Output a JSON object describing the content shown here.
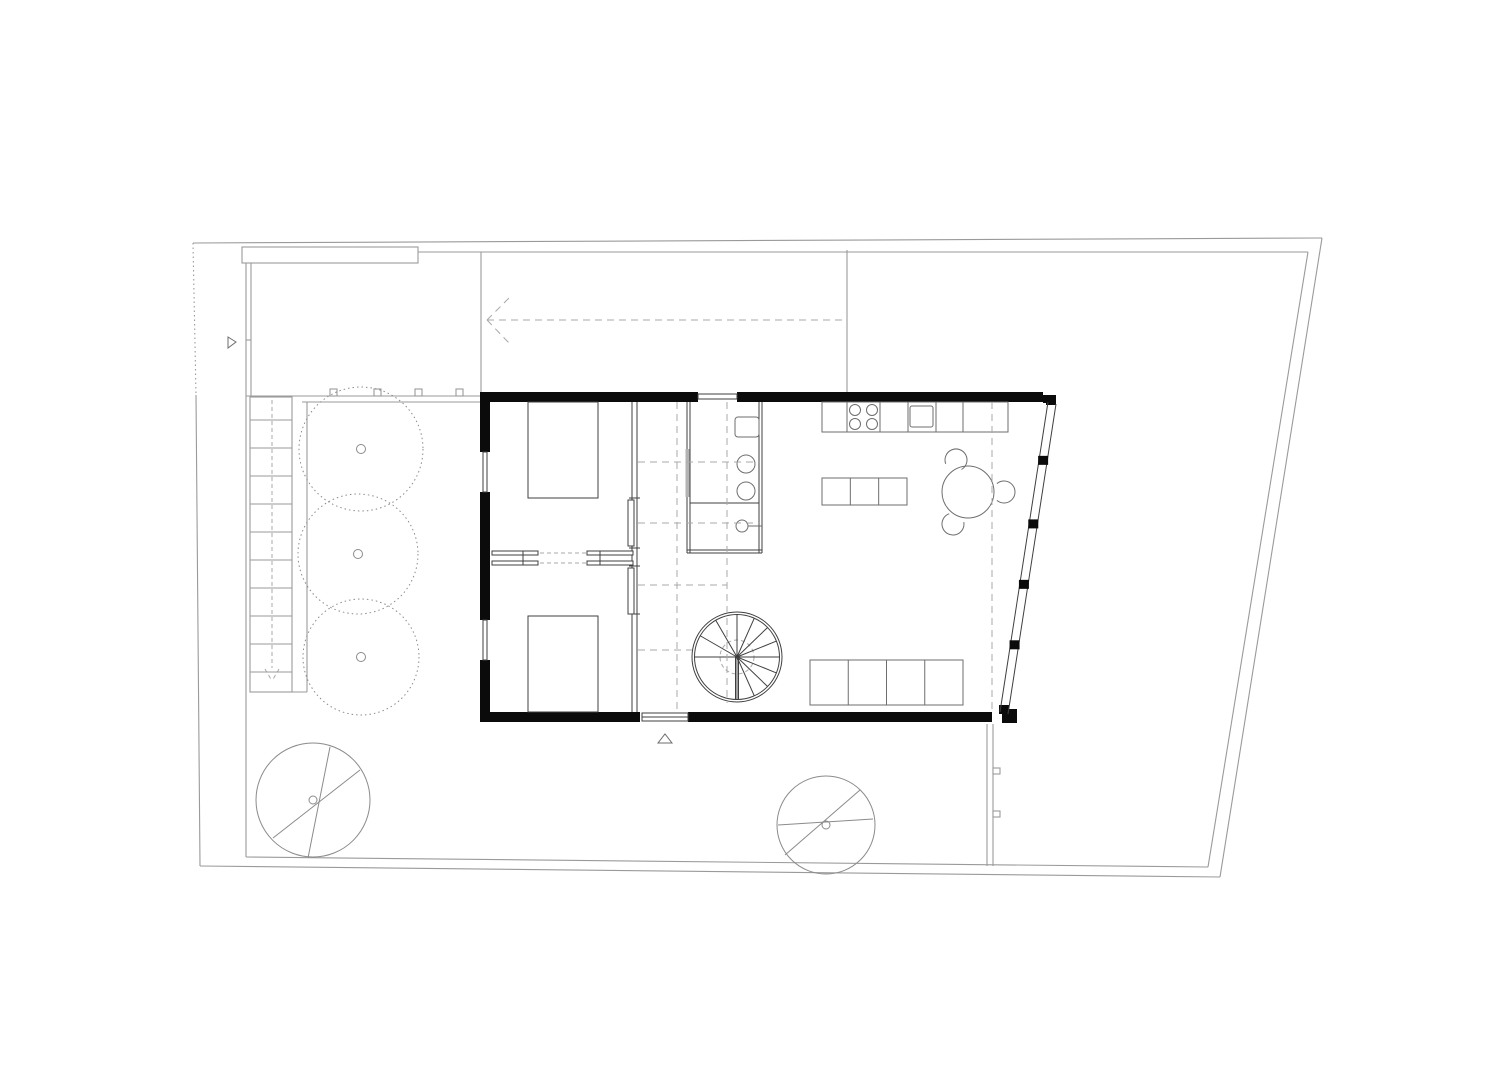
{
  "meta": {
    "title": "ground-floor-plan",
    "canvas": {
      "width": 1512,
      "height": 1068
    },
    "background": "#ffffff"
  },
  "palette": {
    "wall": "#0b0b0b",
    "line_dark": "#3f3f3f",
    "line_mid": "#6e6e6e",
    "line_site": "#9a9a9a",
    "line_dash": "#a8a8a8",
    "tree_line": "#8b8b8b",
    "fill": "#ffffff",
    "door_strip": "#b3b3b3"
  },
  "site": {
    "garden_trees": [
      {
        "cx": 361,
        "cy": 449,
        "r": 62
      },
      {
        "cx": 358,
        "cy": 554,
        "r": 60
      },
      {
        "cx": 361,
        "cy": 657,
        "r": 58
      }
    ],
    "existing_trees": [
      {
        "cx": 313,
        "cy": 800,
        "r": 57,
        "chords": [
          [
            330,
            747,
            308,
            858
          ],
          [
            273,
            838,
            360,
            770
          ]
        ]
      },
      {
        "cx": 826,
        "cy": 825,
        "r": 49,
        "chords": [
          [
            785,
            855,
            860,
            790
          ],
          [
            778,
            825,
            873,
            819
          ]
        ]
      }
    ],
    "stair": {
      "x": 250,
      "y": 397,
      "w": 42,
      "h": 295,
      "tread_start": 420,
      "tread_step": 28,
      "tread_count": 10,
      "center_x": 272
    },
    "fence_tabs_x": [
      330,
      374,
      415,
      456
    ],
    "fence_tab_y": 389,
    "wall_tabs_y": [
      768,
      811
    ],
    "wall_tab_x": 993
  },
  "building": {
    "curtain_wall": {
      "mid_start": [
        1052,
        403
      ],
      "mid_end": [
        1004,
        713
      ],
      "mullion_t": [
        0.185,
        0.39,
        0.585,
        0.78
      ]
    },
    "spiral_stair": {
      "cx": 737,
      "cy": 657,
      "r_outer": 45,
      "r_inner": 42.5,
      "hub_r": 17,
      "tread_angles": [
        180,
        150,
        120,
        90,
        66,
        44,
        22,
        0,
        -22,
        -44,
        -66,
        -90
      ]
    }
  },
  "furniture": {
    "beds": [
      {
        "x": 528,
        "y": 402,
        "w": 70,
        "h": 96
      },
      {
        "x": 528,
        "y": 616,
        "w": 70,
        "h": 96
      }
    ],
    "counter": {
      "x": 822,
      "y": 402,
      "w": 186,
      "h": 30,
      "dividers_x": [
        847,
        880,
        908,
        936,
        963
      ]
    },
    "cooktop": {
      "burners": [
        [
          855,
          410
        ],
        [
          872,
          410
        ],
        [
          855,
          424
        ],
        [
          872,
          424
        ]
      ],
      "r": 5.5
    },
    "sink": {
      "x": 910,
      "y": 406,
      "w": 23,
      "h": 21
    },
    "island": {
      "x": 822,
      "y": 478,
      "w": 85,
      "h": 27,
      "sections": 3
    },
    "dining_table": {
      "cx": 968,
      "cy": 492,
      "r": 26,
      "chairs": 3
    },
    "sofa": {
      "x": 810,
      "y": 660,
      "w": 153,
      "h": 45,
      "sections": 4
    }
  }
}
